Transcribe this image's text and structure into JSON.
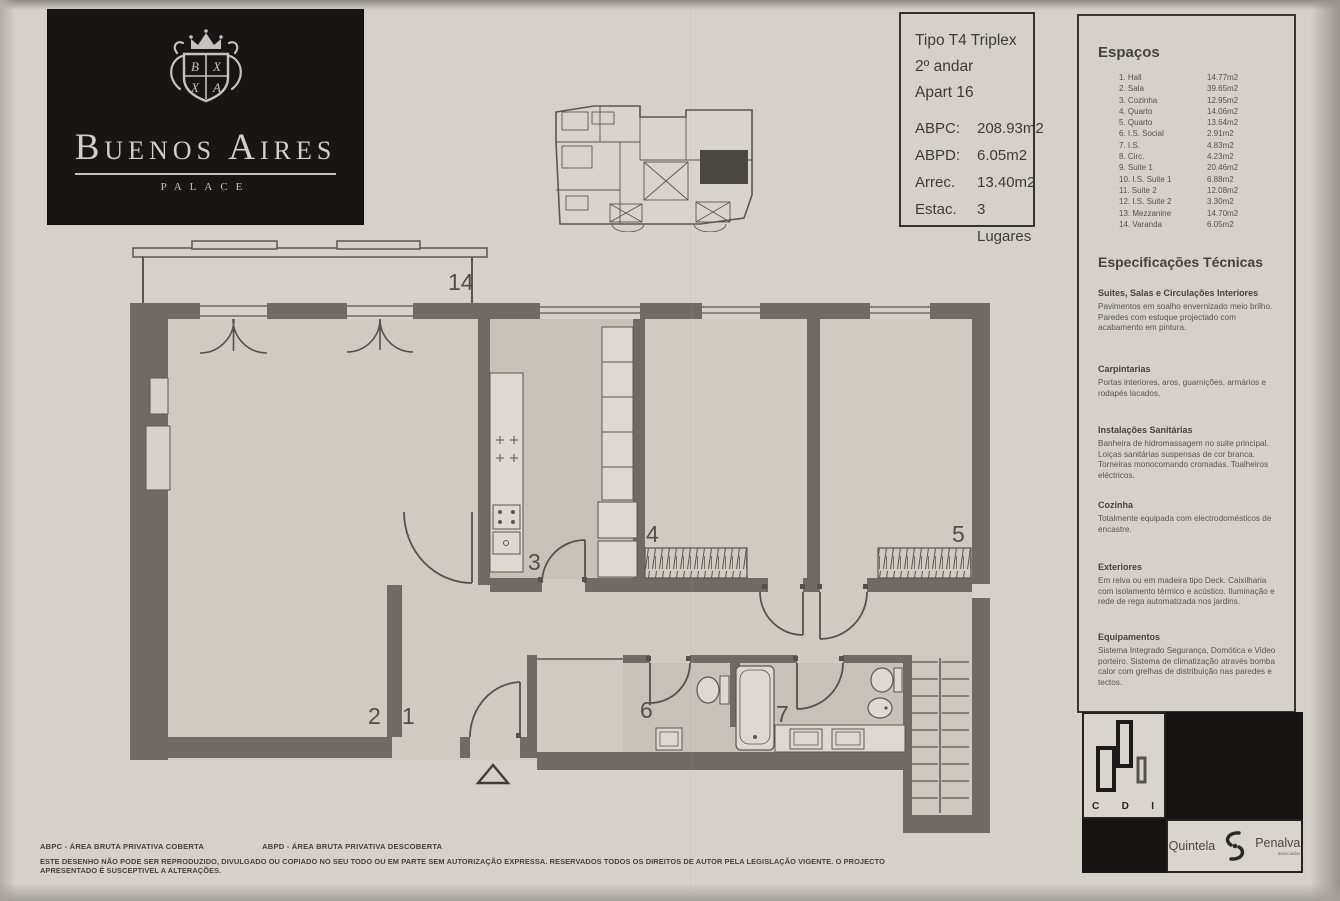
{
  "header": {
    "brand": {
      "name": "Buenos Aires",
      "subtitle": "PALACE",
      "crest_letters": [
        "B",
        "X",
        "X",
        "A"
      ]
    },
    "info_box": {
      "lines": [
        "Tipo T4 Triplex",
        "2º andar",
        "Apart 16"
      ],
      "metrics": [
        {
          "label": "ABPC:",
          "value": "208.93m2"
        },
        {
          "label": "ABPD:",
          "value": "6.05m2"
        },
        {
          "label": "Arrec.",
          "value": "13.40m2"
        },
        {
          "label": "Estac.",
          "value": "3 Lugares"
        }
      ]
    }
  },
  "spaces_panel": {
    "title": "Espaços",
    "items": [
      {
        "num": "1.",
        "name": "Hall",
        "area": "14.77m2"
      },
      {
        "num": "2.",
        "name": "Sala",
        "area": "39.65m2"
      },
      {
        "num": "3.",
        "name": "Cozinha",
        "area": "12.95m2"
      },
      {
        "num": "4.",
        "name": "Quarto",
        "area": "14.06m2"
      },
      {
        "num": "5.",
        "name": "Quarto",
        "area": "13.64m2"
      },
      {
        "num": "6.",
        "name": "I.S. Social",
        "area": "2.91m2"
      },
      {
        "num": "7.",
        "name": "I.S.",
        "area": "4.83m2"
      },
      {
        "num": "8.",
        "name": "Circ.",
        "area": "4.23m2"
      },
      {
        "num": "9.",
        "name": "Suite 1",
        "area": "20.46m2"
      },
      {
        "num": "10.",
        "name": "I.S. Suite 1",
        "area": "6.88m2"
      },
      {
        "num": "11.",
        "name": "Suite 2",
        "area": "12.08m2"
      },
      {
        "num": "12.",
        "name": "I.S. Suite 2",
        "area": "3.30m2"
      },
      {
        "num": "13.",
        "name": "Mezzanine",
        "area": "14.70m2"
      },
      {
        "num": "14.",
        "name": "Varanda",
        "area": "6.05m2"
      }
    ]
  },
  "specs_panel": {
    "title": "Especificações Técnicas",
    "sections": [
      {
        "heading": "Suites, Salas e Circulações Interiores",
        "body": "Pavimentos em soalho envernizado meio brilho. Paredes com estuque projectado com acabamento em pintura."
      },
      {
        "heading": "Carpintarias",
        "body": "Portas interiores, aros, guarnições, armários e rodapés lacados."
      },
      {
        "heading": "Instalações Sanitárias",
        "body": "Banheira de hidromassagem no suite principal. Loiças sanitárias suspensas de cor branca. Torneiras monocomando cromadas. Toalheiros eléctricos."
      },
      {
        "heading": "Cozinha",
        "body": "Totalmente equipada com electrodomésticos de encastre."
      },
      {
        "heading": "Exteriores",
        "body": "Em relva ou em madeira tipo Deck. Caixilharia com isolamento térmico e acústico. Iluminação e rede de rega automatizada nos jardins."
      },
      {
        "heading": "Equipamentos",
        "body": "Sistema Integrado Segurança, Domótica e Video porteiro. Sistema de climatização através bomba calor com grelhas de distribuição nas paredes e tectos."
      }
    ]
  },
  "floorplan": {
    "room_labels": [
      {
        "num": "14",
        "x": 448,
        "y": 290
      },
      {
        "num": "2",
        "x": 368,
        "y": 724
      },
      {
        "num": "1",
        "x": 402,
        "y": 724
      },
      {
        "num": "3",
        "x": 528,
        "y": 570
      },
      {
        "num": "4",
        "x": 646,
        "y": 542
      },
      {
        "num": "5",
        "x": 952,
        "y": 542
      },
      {
        "num": "6",
        "x": 640,
        "y": 718
      },
      {
        "num": "7",
        "x": 776,
        "y": 722
      }
    ]
  },
  "footer": {
    "legend_left": "ABPC - ÁREA BRUTA PRIVATIVA COBERTA",
    "legend_right": "ABPD - ÁREA BRUTA PRIVATIVA DESCOBERTA",
    "disclaimer": "ESTE DESENHO NÃO PODE SER REPRODUZIDO, DIVULGADO OU COPIADO NO SEU TODO OU EM PARTE SEM AUTORIZAÇÃO EXPRESSA. RESERVADOS TODOS OS DIREITOS DE AUTOR PELA LEGISLAÇÃO VIGENTE. O PROJECTO APRESENTADO É SUSCEPTIVEL A ALTERAÇÕES."
  },
  "logos": {
    "cdi": {
      "letters": [
        "C",
        "D",
        "I"
      ]
    },
    "agency": {
      "left": "Quintela",
      "right": "Penalva",
      "sub": "associados"
    }
  }
}
